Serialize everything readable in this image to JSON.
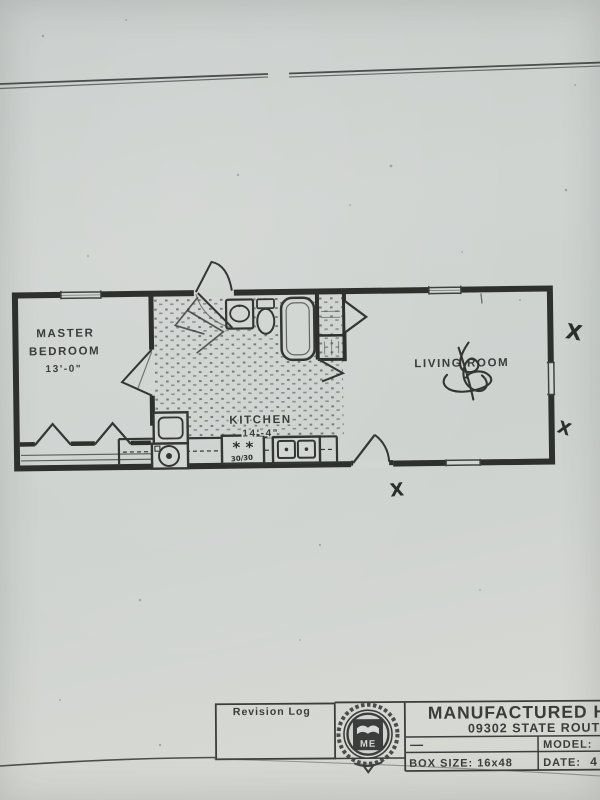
{
  "floor_plan": {
    "rooms": {
      "master_bedroom": {
        "line1": "MASTER",
        "line2": "BEDROOM",
        "dimension": "13'-0\""
      },
      "kitchen": {
        "name": "KITCHEN",
        "dimension": "14'-4\""
      },
      "living_room": {
        "name": "LIVING ROOM"
      }
    },
    "fixtures": [
      "lavatory-sink",
      "toilet",
      "bathtub",
      "range",
      "double-sink",
      "washer",
      "dryer"
    ],
    "annotations": {
      "x_mark_1": "X",
      "x_mark_2": "X",
      "x_mark_3": "X",
      "range_burner_marks": "*  *",
      "range_handwritten_note": "30/30"
    }
  },
  "title_block": {
    "revision_log_label": "Revision Log",
    "company_name_visible": "MANUFACTURED HOU",
    "address_visible": "09302 STATE ROUT",
    "left_cell_mark": "—",
    "model_label": "MODEL:",
    "box_size_label": "BOX SIZE: 16x48",
    "date_label": "DATE:",
    "date_value_visible": "4",
    "logo_monogram": "ME"
  },
  "colors": {
    "paper": "#cfd4d1",
    "ink": "#383b39",
    "wall": "#2e302e"
  }
}
